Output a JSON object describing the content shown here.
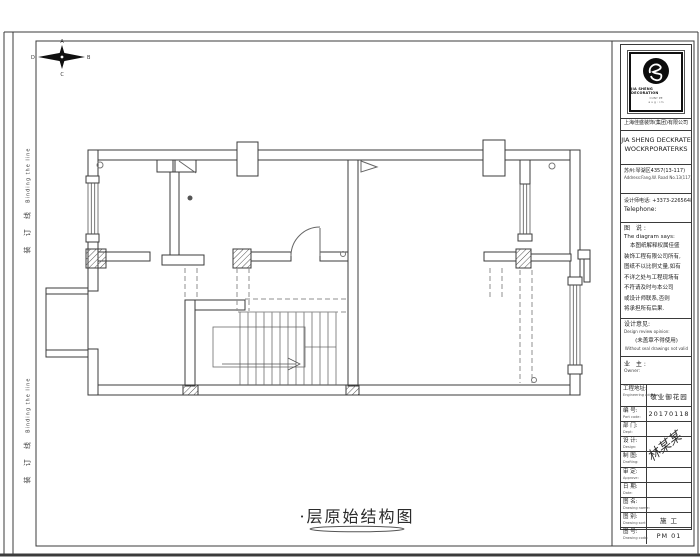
{
  "page": {
    "background": "#ffffff",
    "line_color": "#3b3b3b",
    "dashed_color": "#8f8f8f"
  },
  "margin": {
    "binding_cn": "装 订 线",
    "binding_en": "Binding the line"
  },
  "compass": {
    "north_label": "A",
    "east_label": "B",
    "south_label": "C",
    "west_label": "D"
  },
  "drawing_title": "·层原始结构图",
  "title_block": {
    "logo": {
      "name_en": "JIA SHENG DECORATION",
      "sub1": "CUNY PE",
      "sub2": "a u g : i m"
    },
    "company_cn": "上海佳盛装饰(集团)有限公司",
    "company_en_line1": "JIA SHENG DECKRATE",
    "company_en_line2": "WOCKRPORATERKS",
    "address_cn": "苏州:琴湖区4357(13-117)",
    "address_en": "Address:Fang.W. Road No.13(117)",
    "phone_cn": "设计师电话: +3373-2265648",
    "phone_en": "Telephone:",
    "notes": {
      "title_cn": "图 说:",
      "title_en": "The diagram says:",
      "lines": [
        "本图纸解释权属佳盛",
        "装饰工程有限公司所有,",
        "图纸不以比例丈量,如有",
        "不详之处与工程现场有",
        "不符请及时与本公司",
        "或设计师联系,否则",
        "将承担所有后果."
      ]
    },
    "opinion": {
      "label_cn": "设计意见:",
      "label_en": "Design review opinion:",
      "stamp_cn": "(未盖章不得使用)",
      "stamp_en": "Without seal drawings not valid"
    },
    "owner": {
      "label_cn": "业 主:",
      "label_en": "Owner:"
    },
    "signature": "林某某",
    "table": {
      "rows": [
        {
          "label_cn": "工程地址:",
          "label_en": "Engineering address:",
          "value": "敬业御花园"
        },
        {
          "label_cn": "编 号:",
          "label_en": "Part code:",
          "value": "20170118"
        },
        {
          "label_cn": "部 门:",
          "label_en": "Dept:",
          "value": ""
        },
        {
          "label_cn": "设 计:",
          "label_en": "Design:",
          "value": ""
        },
        {
          "label_cn": "制 图:",
          "label_en": "Drafting:",
          "value": ""
        },
        {
          "label_cn": "审 定:",
          "label_en": "Approve:",
          "value": ""
        },
        {
          "label_cn": "日 期:",
          "label_en": "Date:",
          "value": ""
        },
        {
          "label_cn": "图 名:",
          "label_en": "Drawing name:",
          "value": ""
        },
        {
          "label_cn": "图 别:",
          "label_en": "Drawing sort:",
          "value": "施 工"
        },
        {
          "label_cn": "图 号:",
          "label_en": "Drawing code:",
          "value": "PM 01"
        }
      ]
    }
  }
}
